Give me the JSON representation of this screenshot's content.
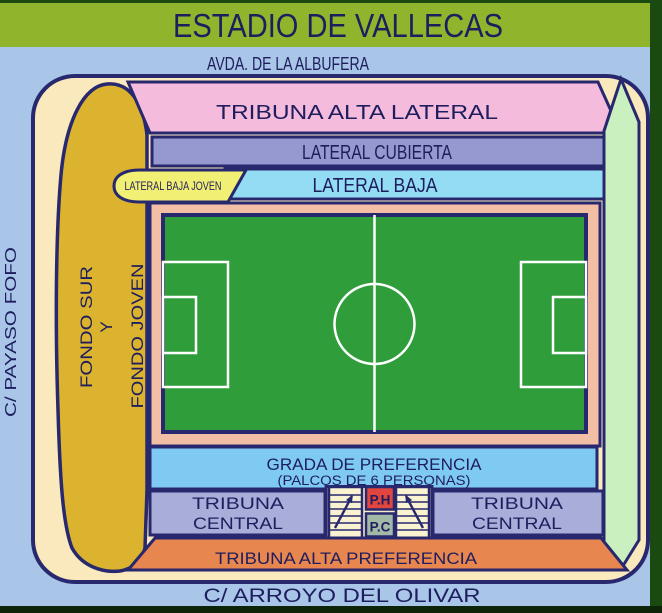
{
  "title": "ESTADIO DE VALLECAS",
  "streets": {
    "top": "AVDA. DE LA ALBUFERA",
    "left": "C/  PAYASO  FOFO",
    "bottom": "C/  ARROYO DEL OLIVAR"
  },
  "sections": {
    "tribuna_alta_lateral": "TRIBUNA  ALTA LATERAL",
    "lateral_cubierta": "LATERAL CUBIERTA",
    "lateral_baja": "LATERAL  BAJA",
    "lateral_baja_joven": "LATERAL BAJA JOVEN",
    "fondo_line1": "FONDO  SUR",
    "fondo_line2": "Y",
    "fondo_line3": "FONDO  JOVEN",
    "grada_line1": "GRADA  DE  PREFERENCIA",
    "grada_line2": "(PALCOS  DE  6  PERSONAS)",
    "tribuna_central_line1": "TRIBUNA",
    "tribuna_central_line2": "CENTRAL",
    "tribuna_alta_preferencia": "TRIBUNA  ALTA  PREFERENCIA",
    "palco_honor": "P.H",
    "palco_central": "P.C"
  },
  "colors": {
    "header_green": "#90b52c",
    "dark_green_edge": "#1b4a10",
    "dark_bottom_edge": "#0e2408",
    "street_blue": "#a9c6e9",
    "stadium_beige": "#f9e9bd",
    "outline_navy": "#28286e",
    "text_navy": "#1e1e5e",
    "pink": "#f4bbdc",
    "lavender": "#9599cf",
    "cyan": "#93dcf4",
    "yellow": "#f2ef75",
    "gold": "#dcb32f",
    "light_green": "#cbf0c0",
    "salmon_frame": "#f2bfa6",
    "pitch_green": "#2f9e3a",
    "sky_blue": "#7fcaf2",
    "periwinkle": "#a9add9",
    "orange": "#e8864f",
    "ph_red": "#e1453e",
    "pc_sage": "#a2b9a8",
    "stairs_cream": "#faf3d2"
  }
}
